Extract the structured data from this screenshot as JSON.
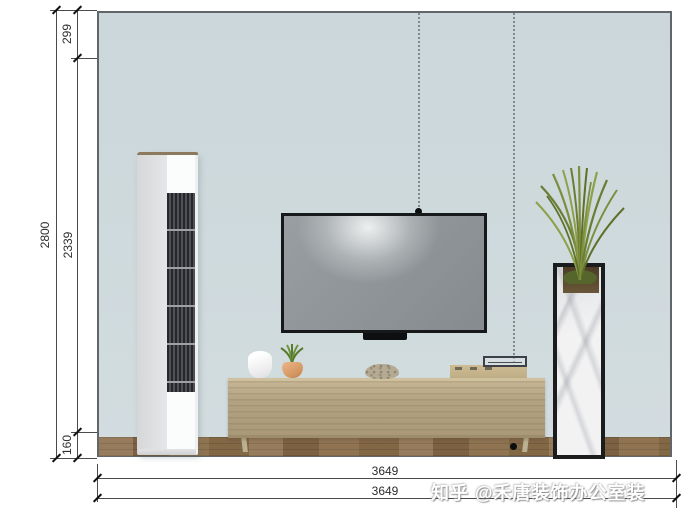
{
  "scene": {
    "type": "interior-elevation-tv-wall",
    "wall_color": "#cdd8dc",
    "floor_color": "#8a6d49",
    "cabinet_color": "#b3a382",
    "objects": [
      "air-conditioner",
      "tv",
      "soundbar",
      "tv-cabinet",
      "white-vase",
      "potted-plant",
      "stone-bowl",
      "radio",
      "marble-planter",
      "grass-plant",
      "pendant-drop-lines"
    ]
  },
  "dimensions": {
    "vertical": {
      "total": "2800",
      "segments": [
        {
          "value": "299"
        },
        {
          "value": "2339"
        },
        {
          "value": "160"
        }
      ]
    },
    "horizontal": {
      "top": "3649",
      "bottom": "3649"
    }
  },
  "watermark": {
    "text": "知乎 @禾唐装饰办公室装"
  }
}
